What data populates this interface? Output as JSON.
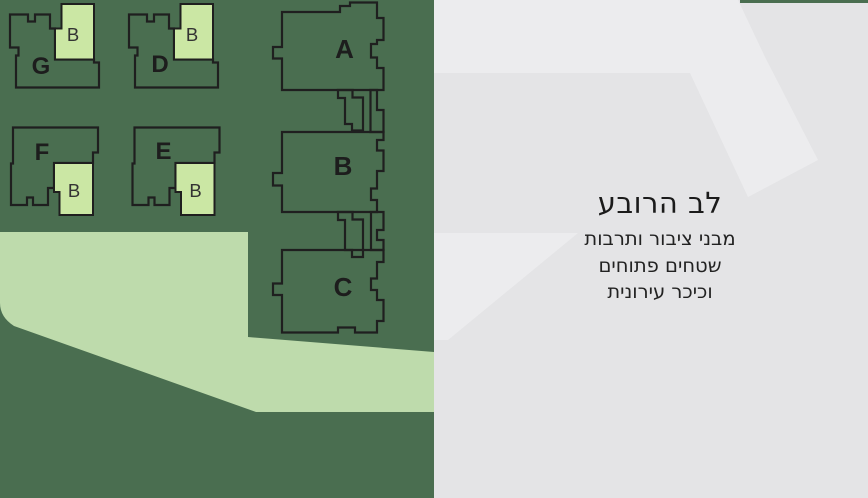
{
  "map": {
    "background_color": "#4a6e50",
    "outline_color": "#1f1f1f",
    "annex_fill_color": "#cbe7a4",
    "path_fill_color": "#bedbac",
    "buildings": [
      {
        "label": "G"
      },
      {
        "label": "D"
      },
      {
        "label": "F"
      },
      {
        "label": "E"
      },
      {
        "label": "A"
      },
      {
        "label": "B"
      },
      {
        "label": "C"
      }
    ],
    "annexes": [
      {
        "label": "B"
      },
      {
        "label": "B"
      },
      {
        "label": "B"
      },
      {
        "label": "B"
      }
    ]
  },
  "panel": {
    "background_color": "#e4e4e6",
    "shape_color": "#ececee",
    "title": "לב הרובע",
    "subtitle_lines": [
      "מבני ציבור ותרבות",
      "שטחים פתוחים",
      "וכיכר עירונית"
    ]
  }
}
